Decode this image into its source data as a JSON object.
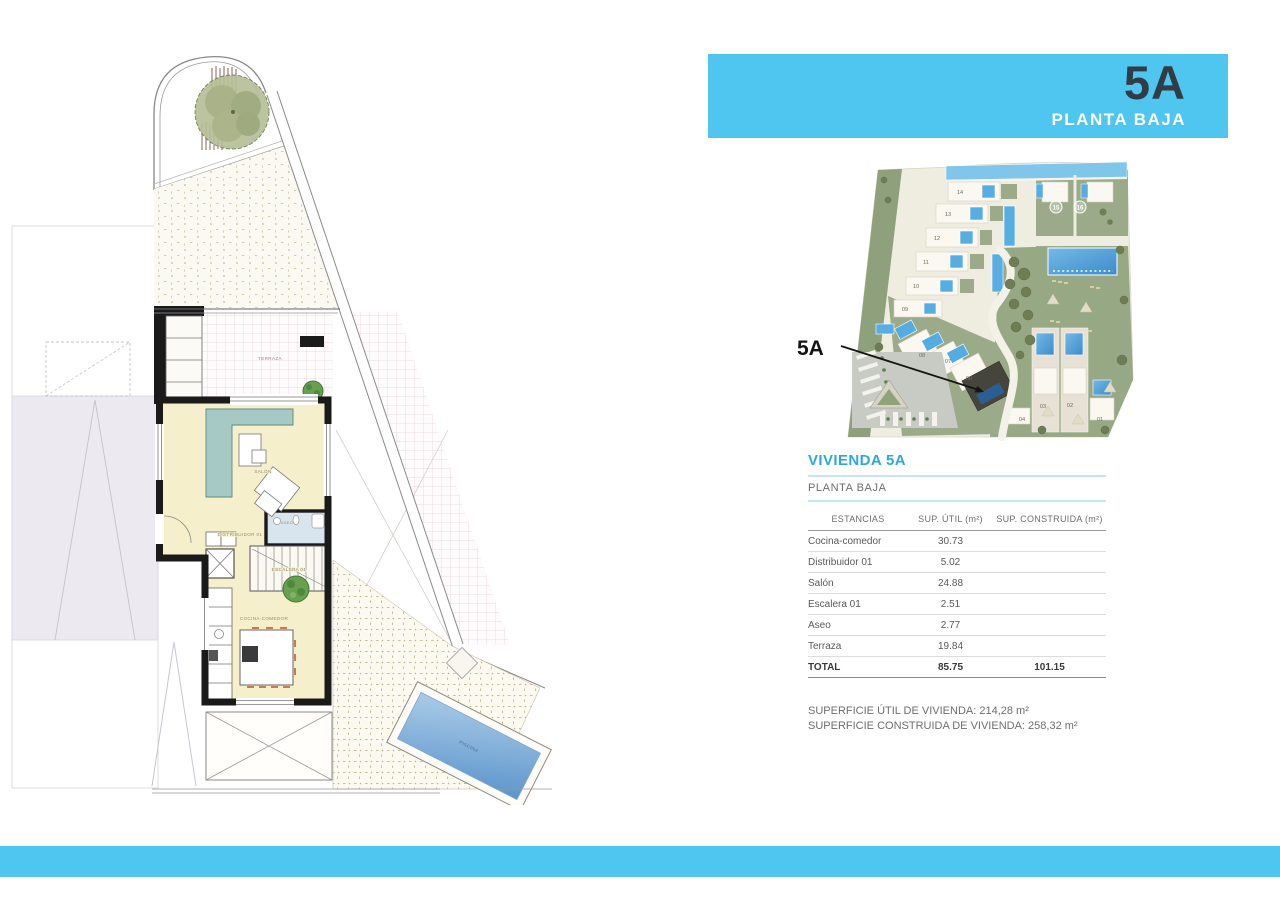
{
  "header": {
    "unit": "5A",
    "floor": "PLANTA BAJA",
    "bg_color": "#4FC6EF",
    "unit_color": "#323C46"
  },
  "site_plan": {
    "callout_label": "5A",
    "units": [
      "14",
      "13",
      "12",
      "11",
      "10",
      "09",
      "08",
      "07",
      "06",
      "04",
      "03",
      "02",
      "01"
    ],
    "circled": [
      "15",
      "16"
    ]
  },
  "floor_plan": {
    "labels": {
      "terraza": "TERRAZA",
      "salon": "SALÓN",
      "distribuidor": "DISTRIBUIDOR 01",
      "aseo": "ASEO",
      "escalera": "ESCALERA 01",
      "cocina": "COCINA-COMEDOR",
      "piscina": "PISCINA"
    }
  },
  "details": {
    "title": "VIVIENDA 5A",
    "subtitle": "PLANTA BAJA",
    "table": {
      "headers": [
        "ESTANCIAS",
        "SUP. ÚTIL (m²)",
        "SUP. CONSTRUIDA (m²)"
      ],
      "rows": [
        {
          "name": "Cocina-comedor",
          "util": "30.73",
          "construida": ""
        },
        {
          "name": "Distribuidor 01",
          "util": "5.02",
          "construida": ""
        },
        {
          "name": "Salón",
          "util": "24.88",
          "construida": ""
        },
        {
          "name": "Escalera 01",
          "util": "2.51",
          "construida": ""
        },
        {
          "name": "Aseo",
          "util": "2.77",
          "construida": ""
        },
        {
          "name": "Terraza",
          "util": "19.84",
          "construida": ""
        }
      ],
      "total": {
        "name": "TOTAL",
        "util": "85.75",
        "construida": "101.15"
      }
    },
    "summary_line1": "SUPERFICIE ÚTIL DE VIVIENDA: 214,28 m²",
    "summary_line2": "SUPERFICIE CONSTRUIDA DE VIVIENDA: 258,32 m²"
  },
  "footer": {
    "bar_color": "#4FC6EF"
  }
}
